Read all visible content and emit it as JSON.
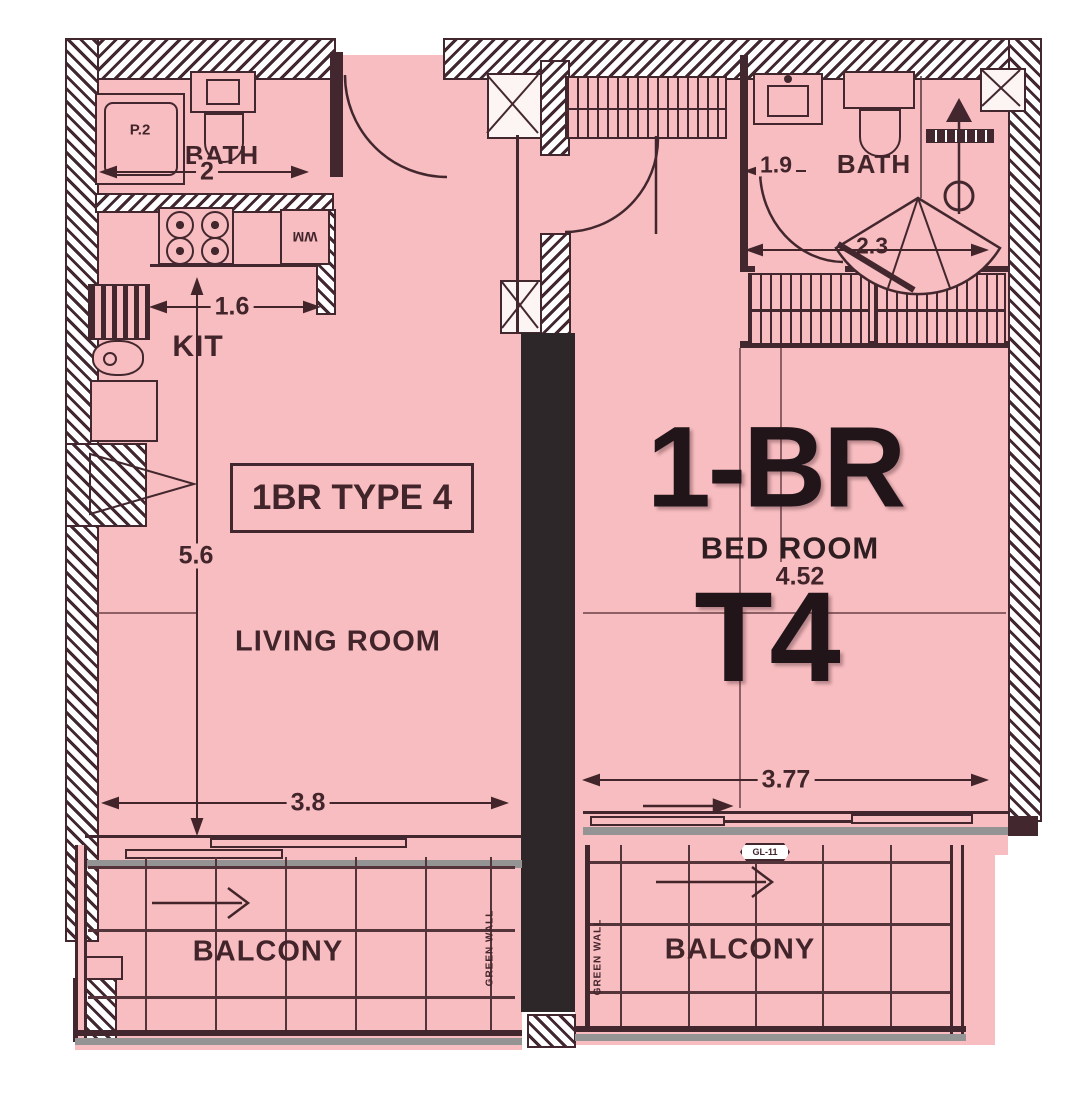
{
  "title_box": "1BR TYPE 4",
  "bedroom": {
    "main": "1-BR",
    "sub": "BED ROOM",
    "type": "T4"
  },
  "rooms": {
    "bath_left": "BATH",
    "bath_right": "BATH",
    "kitchen": "KIT",
    "living": "LIVING ROOM",
    "balcony_left": "BALCONY",
    "balcony_right": "BALCONY"
  },
  "labels": {
    "wm": "WM",
    "shower_tray": "P.2",
    "glass_tag": "GL-11",
    "green_wall_left": "GREEN WALL",
    "green_wall_right": "GREEN WALL"
  },
  "dimensions": {
    "bath_left_width": "2",
    "kitchen_width": "1.6",
    "living_height": "5.6",
    "living_width": "3.8",
    "bath_right_entry": "1.9",
    "bath_right_width": "2.3",
    "bedroom_height": "4.52",
    "bedroom_width": "3.77"
  },
  "colors": {
    "floor_pink": "#f8bdc0",
    "ink": "#42282e",
    "line": "#53343a",
    "big_text": "#211519",
    "sill_gray": "#949494",
    "shaft_black": "#2e272a"
  }
}
